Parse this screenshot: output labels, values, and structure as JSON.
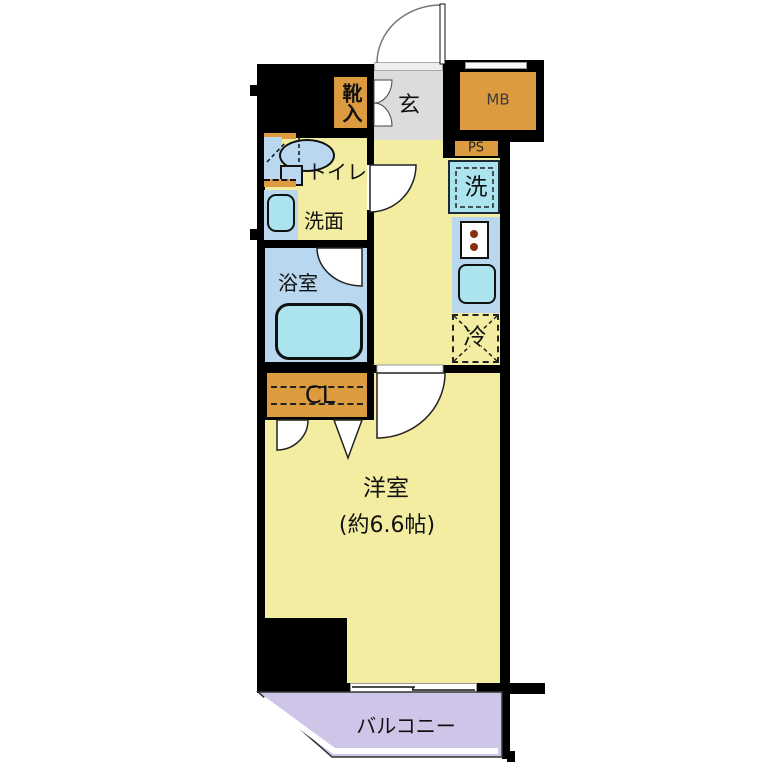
{
  "floorplan": {
    "rooms": {
      "genkan": {
        "label": "玄"
      },
      "shoe_cabinet": {
        "label": "靴入"
      },
      "meter_box": {
        "label": "MB"
      },
      "pipe_space": {
        "label": "PS"
      },
      "washing_machine": {
        "label": "洗"
      },
      "toilet": {
        "label": "トイレ"
      },
      "washroom": {
        "label": "洗面"
      },
      "bathroom": {
        "label": "浴室"
      },
      "refrigerator": {
        "label": "冷"
      },
      "closet": {
        "label": "CL"
      },
      "western_room": {
        "label": "洋室",
        "size": "(約6.6帖)"
      },
      "balcony": {
        "label": "バルコニー"
      }
    },
    "colors": {
      "wall_black": "#000000",
      "room_yellow": "#f2eda1",
      "entry_gray": "#dcdcdc",
      "cabinet_orange": "#dd9b40",
      "wet_area_blue": "#b9d7ee",
      "fixture_cyan": "#abe4ef",
      "balcony_purple": "#cfc5e8",
      "background": "#ffffff"
    }
  }
}
